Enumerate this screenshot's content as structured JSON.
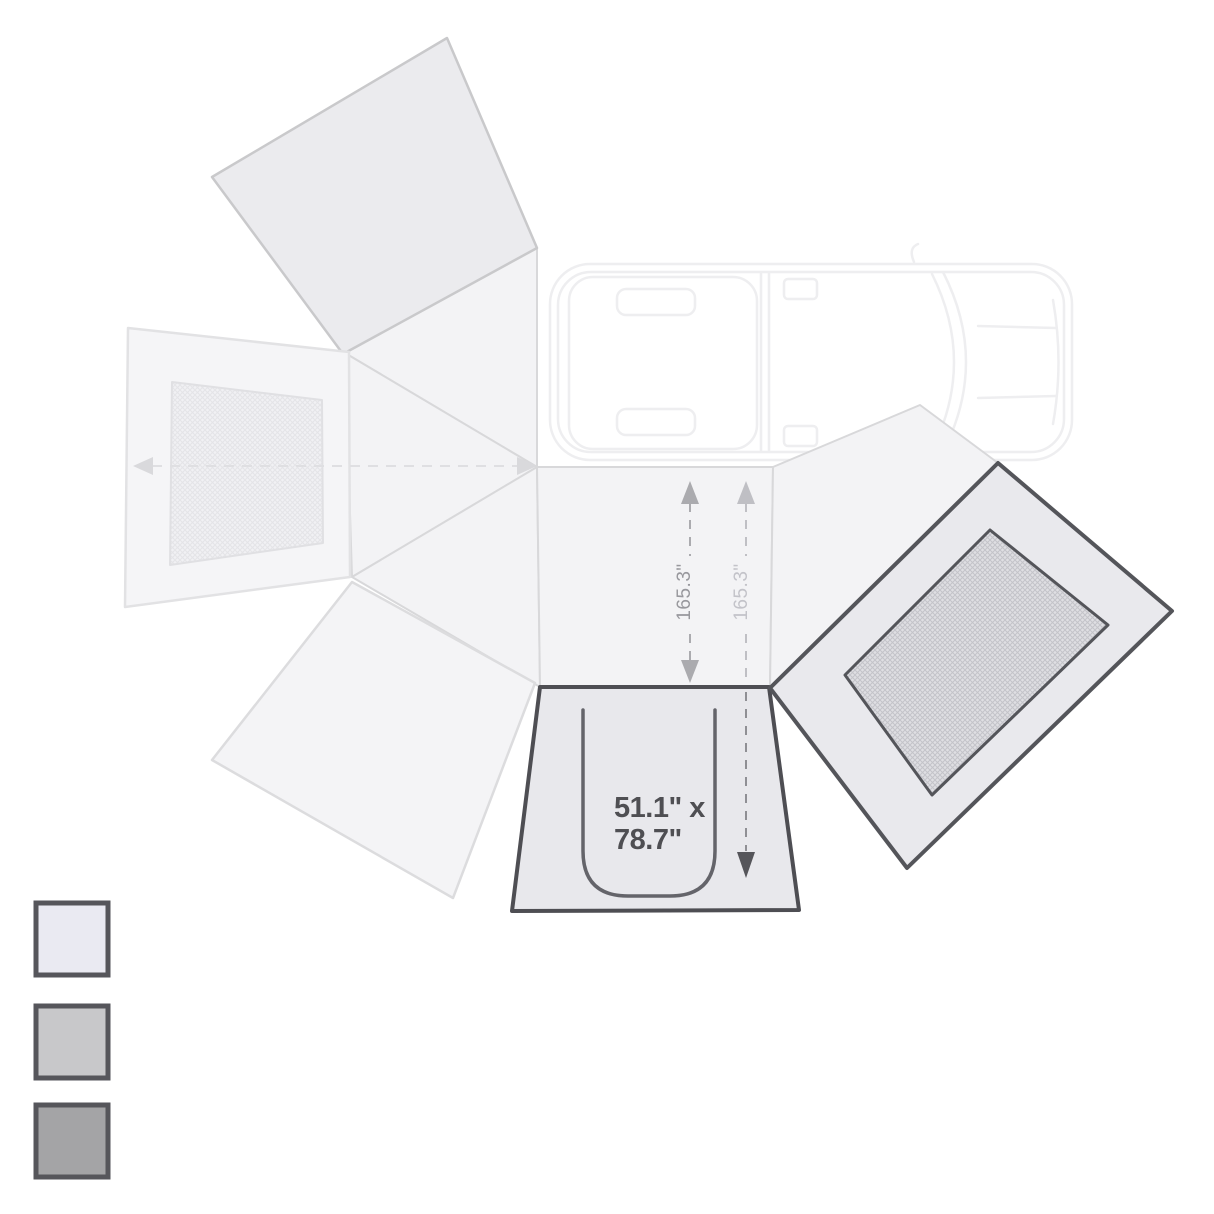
{
  "diagram": {
    "kind": "awning-wall-kit-top-view",
    "labels": {
      "dim_left_vertical": "165.3\"",
      "dim_right_vertical": "165.3\"",
      "door_dim_line1": "51.1\" x",
      "door_dim_line2": "78.7\""
    },
    "door_dimension": "51.1\" x 78.7\"",
    "projection_dimension": "165.3\""
  },
  "swatches": [
    {
      "name": "light-gray",
      "color": "#eaeaf2"
    },
    {
      "name": "medium-gray",
      "color": "#c8c8ca"
    },
    {
      "name": "dark-gray",
      "color": "#a4a4a6"
    }
  ],
  "colors": {
    "panel_border_dark": "#54555a",
    "door_panel_fill": "#e8e8ec",
    "right_panel_fill": "#e9e9ed",
    "fan_fill": "#f3f3f5",
    "fan_stroke": "#d8d8da",
    "shaded_wing_fill": "#ebebee",
    "vehicle_stroke": "#eeeef0",
    "dim_text_dark": "#98989d",
    "dim_text_light": "#c3c3c9",
    "door_text": "#4f4f53",
    "swatch_border": "#56565b"
  }
}
